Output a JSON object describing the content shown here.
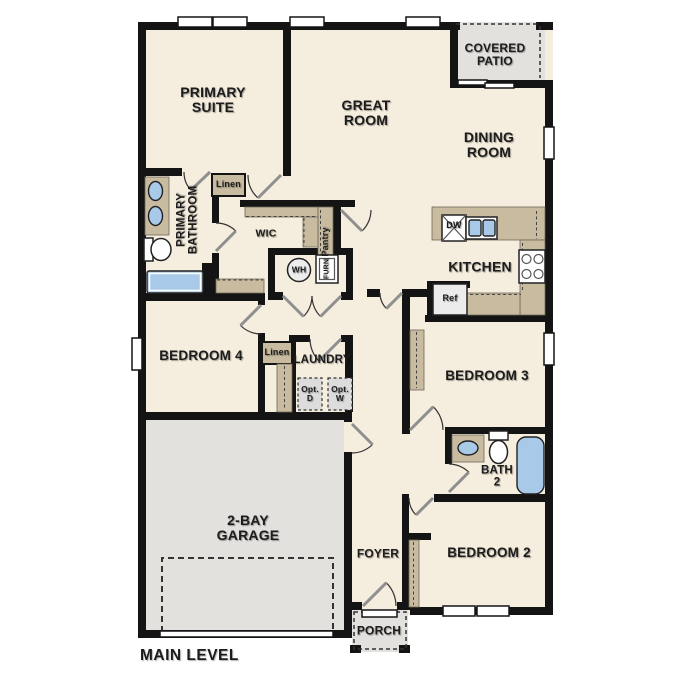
{
  "plan_title": "MAIN LEVEL",
  "colors": {
    "floor": "#f5eddd",
    "exterior_floor": "#e2e1de",
    "wall": "#141414",
    "cabinet": "#c8bba0",
    "fixture": "#a9c9e9"
  },
  "rooms": {
    "primary_suite": "PRIMARY\nSUITE",
    "great_room": "GREAT\nROOM",
    "dining_room": "DINING\nROOM",
    "covered_patio": "COVERED\nPATIO",
    "primary_bathroom": "PRIMARY\nBATHROOM",
    "wic": "WIC",
    "pantry": "Pantry",
    "kitchen": "KITCHEN",
    "bedroom_4": "BEDROOM 4",
    "laundry": "LAUNDRY",
    "bedroom_3": "BEDROOM 3",
    "garage": "2-BAY\nGARAGE",
    "foyer": "FOYER",
    "bath_2": "BATH\n2",
    "bedroom_2": "BEDROOM 2",
    "porch": "PORCH"
  },
  "closets": {
    "linen_1": "Linen",
    "linen_2": "Linen"
  },
  "fixtures": {
    "dishwasher": "DW",
    "refrigerator": "Ref",
    "water_heater": "WH",
    "furnace": "FURN",
    "opt_dryer": "Opt.\nD",
    "opt_washer": "Opt.\nW"
  }
}
